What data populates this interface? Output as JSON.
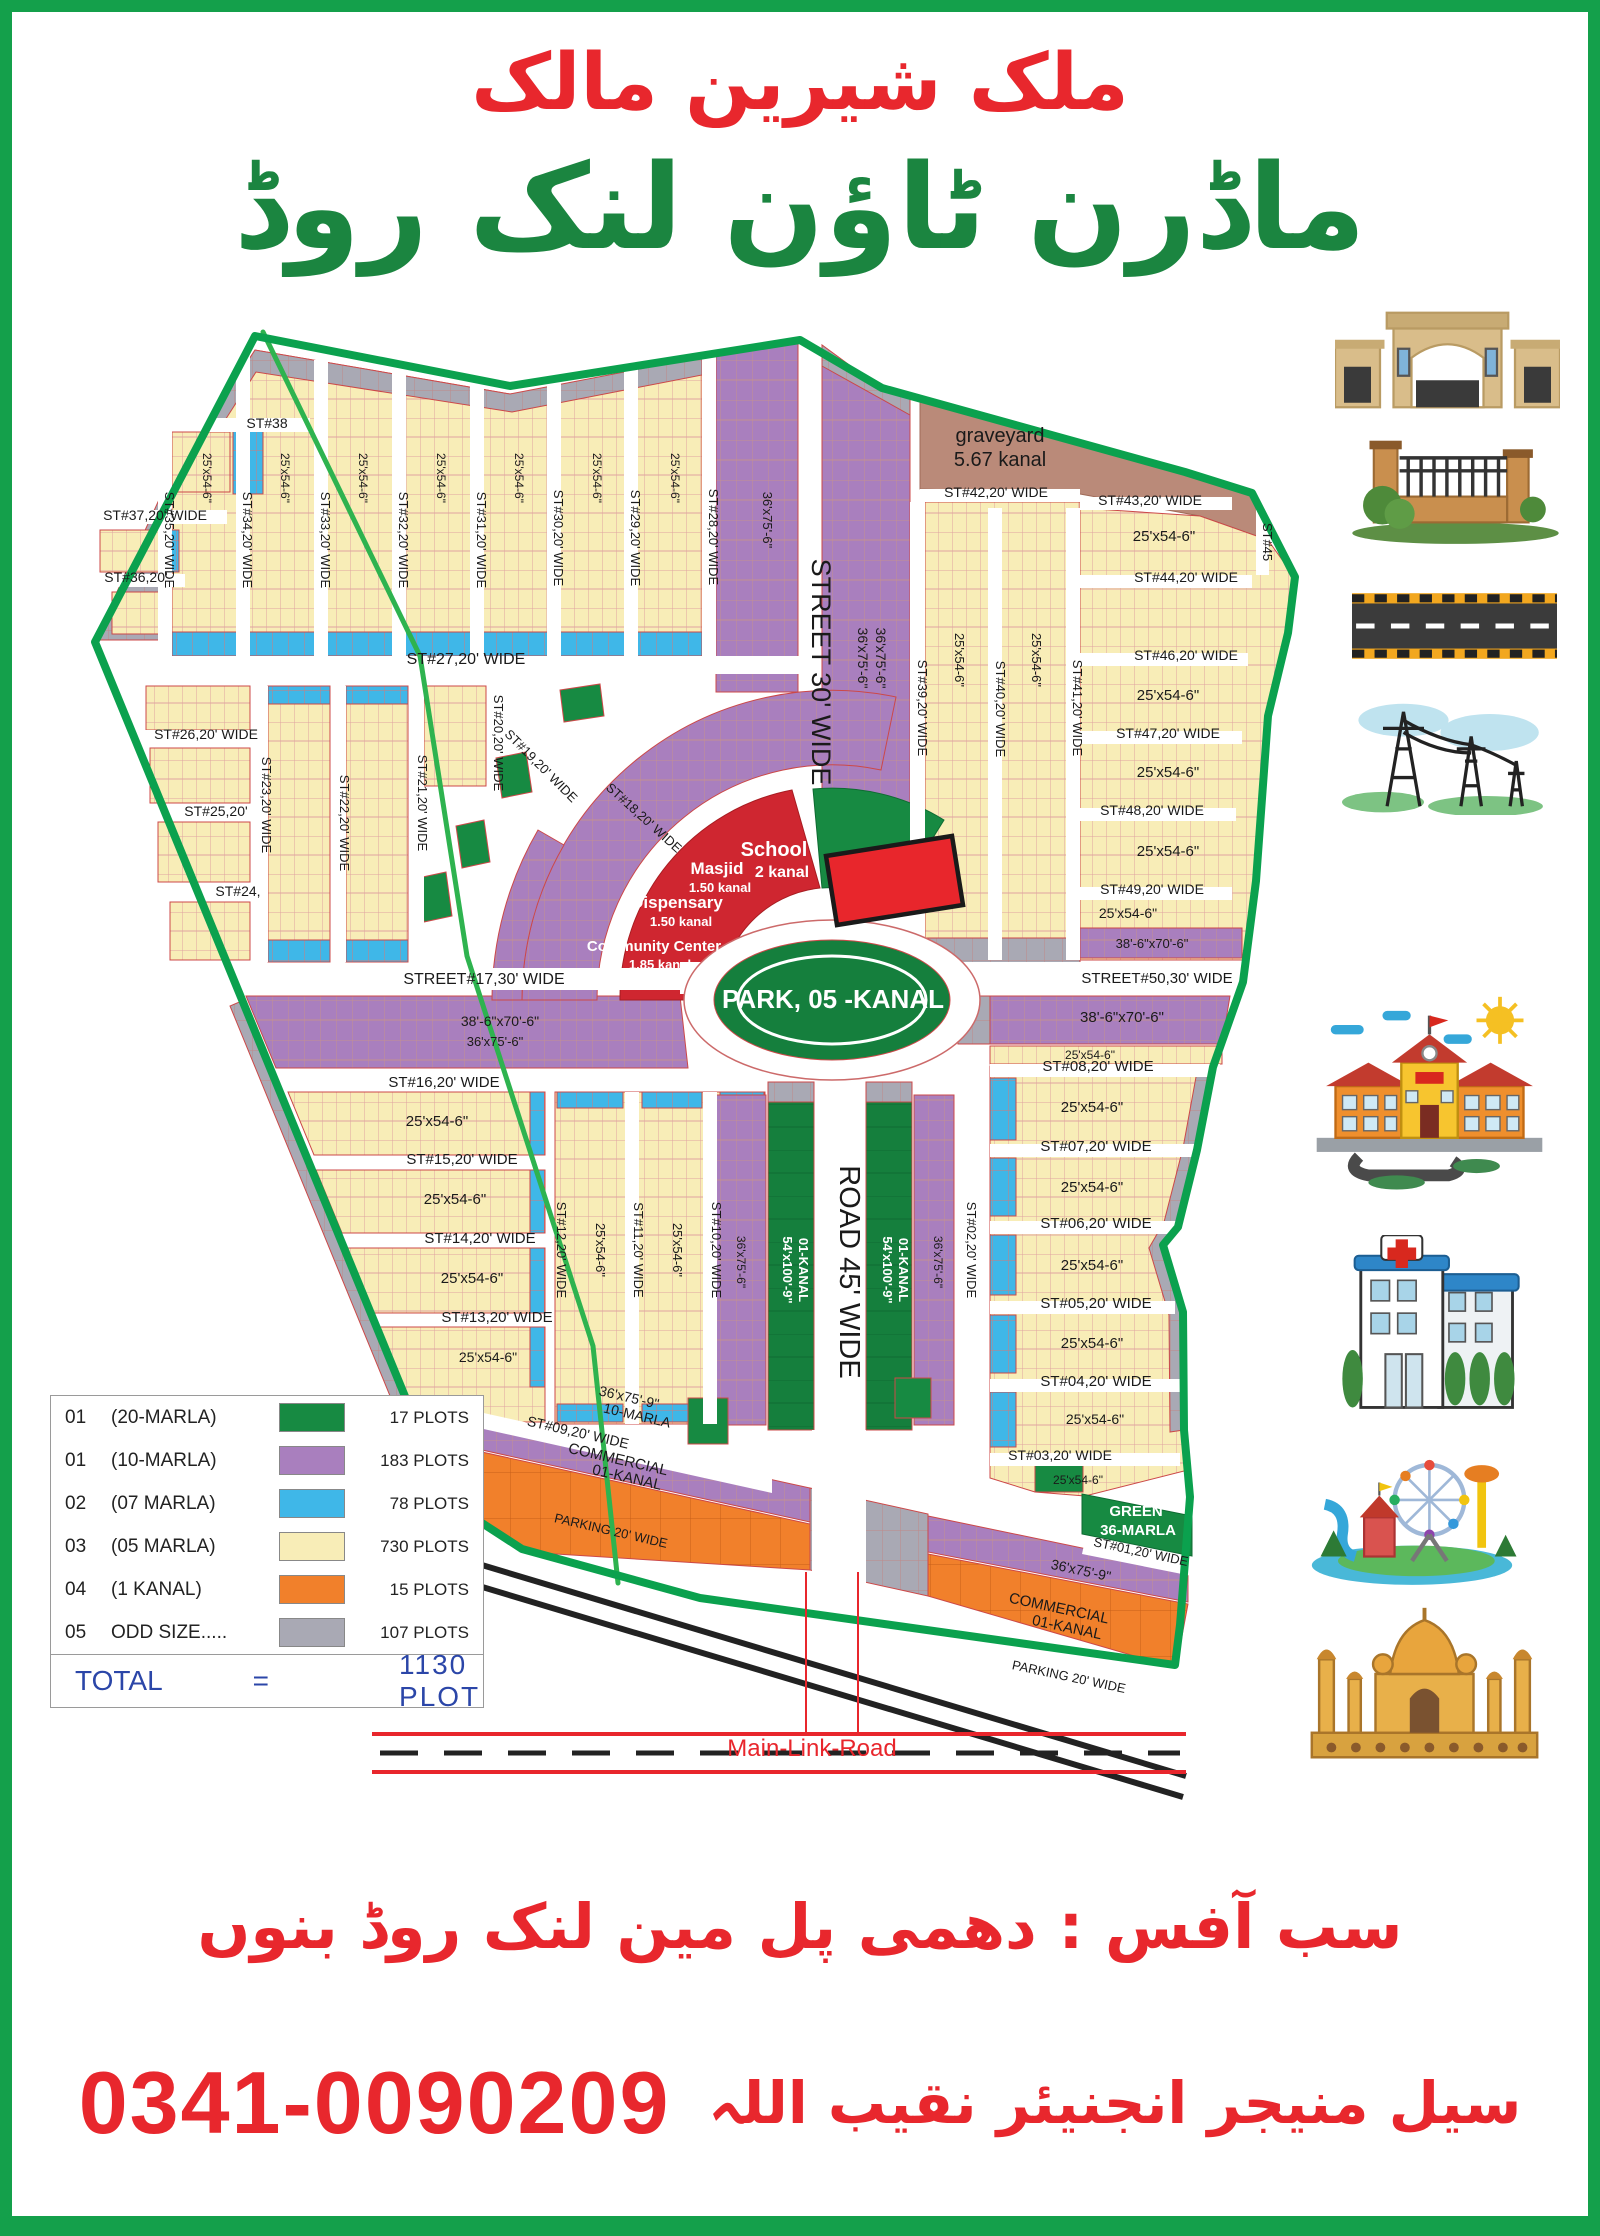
{
  "title": {
    "owner_urdu": "ملک شیرین مالک",
    "project_urdu": "ماڈرن ٹاؤن لنک روڈ"
  },
  "colors": {
    "boundary_green": "#0ba14e",
    "marla20_green": "#178a42",
    "marla10_purple": "#a97fbe",
    "marla7_blue": "#3fb7e8",
    "marla5_yellow": "#f8edb7",
    "kanal_orange": "#f1802b",
    "odd_gray": "#a9a9b4",
    "graveyard_brown": "#ba8a79",
    "facility_red": "#cf2630",
    "urdu_red": "#e8272d",
    "urdu_green": "#1b8540",
    "total_blue": "#2b46a8"
  },
  "legend": {
    "rows": [
      {
        "no": "01",
        "size": "(20-MARLA)",
        "plots": "17 PLOTS",
        "color": "#178a42"
      },
      {
        "no": "01",
        "size": "(10-MARLA)",
        "plots": "183 PLOTS",
        "color": "#a97fbe"
      },
      {
        "no": "02",
        "size": "(07 MARLA)",
        "plots": "78 PLOTS",
        "color": "#3fb7e8"
      },
      {
        "no": "03",
        "size": "(05 MARLA)",
        "plots": "730 PLOTS",
        "color": "#f8edb7"
      },
      {
        "no": "04",
        "size": "(1 KANAL)",
        "plots": "15 PLOTS",
        "color": "#f1802b"
      },
      {
        "no": "05",
        "size": "ODD SIZE.....",
        "plots": "107 PLOTS",
        "color": "#a9a9b4"
      }
    ],
    "total_label": "TOTAL",
    "equals_sign": "=",
    "total_value": "1130  PLOT"
  },
  "footer": {
    "office_urdu": "سب آفس : دھمی پل مین لنک روڈ بنوں",
    "manager_urdu": "سیل منیجر انجنیئر نقیب اللہ",
    "phone": "0341-0090209"
  },
  "icons": {
    "items": [
      "main-gate",
      "boundary-wall",
      "carpeted-road",
      "electricity-towers",
      "school",
      "hospital",
      "amusement-park",
      "mosque"
    ]
  },
  "map": {
    "street_labels": [
      {
        "t": "ST#38",
        "x": 267,
        "y": 428,
        "s": 14
      },
      {
        "t": "ST#37,20' WIDE",
        "x": 155,
        "y": 520,
        "s": 14
      },
      {
        "t": "ST#36,20'",
        "x": 136,
        "y": 582,
        "s": 14
      },
      {
        "t": "ST#27,20' WIDE",
        "x": 466,
        "y": 664,
        "s": 16
      },
      {
        "t": "ST#26,20' WIDE",
        "x": 206,
        "y": 739,
        "s": 14
      },
      {
        "t": "ST#25,20'",
        "x": 216,
        "y": 816,
        "s": 14
      },
      {
        "t": "ST#24,",
        "x": 238,
        "y": 896,
        "s": 14
      },
      {
        "t": "STREET#17,30' WIDE",
        "x": 484,
        "y": 984,
        "s": 16
      },
      {
        "t": "ST#16,20' WIDE",
        "x": 444,
        "y": 1087,
        "s": 15
      },
      {
        "t": "ST#15,20' WIDE",
        "x": 462,
        "y": 1164,
        "s": 15
      },
      {
        "t": "ST#14,20' WIDE",
        "x": 480,
        "y": 1243,
        "s": 15
      },
      {
        "t": "ST#13,20' WIDE",
        "x": 497,
        "y": 1322,
        "s": 15
      },
      {
        "t": "ST#09,20' WIDE",
        "x": 577,
        "y": 1437,
        "s": 14,
        "r": 13
      },
      {
        "t": "ST#42,20' WIDE",
        "x": 996,
        "y": 497,
        "s": 14
      },
      {
        "t": "ST#43,20' WIDE",
        "x": 1150,
        "y": 505,
        "s": 14
      },
      {
        "t": "ST#44,20' WIDE",
        "x": 1186,
        "y": 582,
        "s": 14
      },
      {
        "t": "ST#46,20' WIDE",
        "x": 1186,
        "y": 660,
        "s": 14
      },
      {
        "t": "ST#47,20' WIDE",
        "x": 1168,
        "y": 738,
        "s": 14
      },
      {
        "t": "ST#48,20' WIDE",
        "x": 1152,
        "y": 815,
        "s": 14
      },
      {
        "t": "ST#49,20' WIDE",
        "x": 1152,
        "y": 894,
        "s": 14
      },
      {
        "t": "STREET#50,30' WIDE",
        "x": 1157,
        "y": 983,
        "s": 15
      },
      {
        "t": "ST#08,20' WIDE",
        "x": 1098,
        "y": 1071,
        "s": 15
      },
      {
        "t": "ST#07,20' WIDE",
        "x": 1096,
        "y": 1151,
        "s": 15
      },
      {
        "t": "ST#06,20' WIDE",
        "x": 1096,
        "y": 1228,
        "s": 15
      },
      {
        "t": "ST#05,20' WIDE",
        "x": 1096,
        "y": 1308,
        "s": 15
      },
      {
        "t": "ST#04,20' WIDE",
        "x": 1096,
        "y": 1386,
        "s": 15
      },
      {
        "t": "ST#03,20' WIDE",
        "x": 1060,
        "y": 1460,
        "s": 14
      },
      {
        "t": "ST#01,20' WIDE",
        "x": 1140,
        "y": 1556,
        "s": 13,
        "r": 12
      },
      {
        "t": "ST#35,20' WIDE",
        "x": 165,
        "y": 540,
        "r": 90,
        "s": 13
      },
      {
        "t": "ST#34,20' WIDE",
        "x": 243,
        "y": 540,
        "r": 90,
        "s": 13
      },
      {
        "t": "ST#33,20' WIDE",
        "x": 321,
        "y": 540,
        "r": 90,
        "s": 13
      },
      {
        "t": "ST#32,20' WIDE",
        "x": 399,
        "y": 540,
        "r": 90,
        "s": 13
      },
      {
        "t": "ST#31,20' WIDE",
        "x": 477,
        "y": 540,
        "r": 90,
        "s": 13
      },
      {
        "t": "ST#30,20' WIDE",
        "x": 554,
        "y": 538,
        "r": 90,
        "s": 13
      },
      {
        "t": "ST#29,20' WIDE",
        "x": 631,
        "y": 538,
        "r": 90,
        "s": 13
      },
      {
        "t": "ST#28,20' WIDE",
        "x": 709,
        "y": 537,
        "r": 90,
        "s": 13
      },
      {
        "t": "STREET 30' WIDE",
        "x": 812,
        "y": 672,
        "r": 90,
        "s": 27
      },
      {
        "t": "ST#39,20' WIDE",
        "x": 918,
        "y": 708,
        "r": 90,
        "s": 13
      },
      {
        "t": "ST#40,20' WIDE",
        "x": 996,
        "y": 709,
        "r": 90,
        "s": 13
      },
      {
        "t": "ST#41,20' WIDE",
        "x": 1073,
        "y": 708,
        "r": 90,
        "s": 13
      },
      {
        "t": "ST#45",
        "x": 1263,
        "y": 542,
        "r": 90,
        "s": 13
      },
      {
        "t": "ST#23,20' WIDE",
        "x": 262,
        "y": 805,
        "r": 90,
        "s": 13
      },
      {
        "t": "ST#22,20' WIDE",
        "x": 340,
        "y": 823,
        "r": 90,
        "s": 13
      },
      {
        "t": "ST#21,20' WIDE",
        "x": 418,
        "y": 803,
        "r": 90,
        "s": 13
      },
      {
        "t": "ST#20,20' WIDE",
        "x": 494,
        "y": 743,
        "r": 90,
        "s": 13
      },
      {
        "t": "ST#19,20' WIDE",
        "x": 538,
        "y": 769,
        "r": 45,
        "s": 13
      },
      {
        "t": "ST#18,20' WIDE",
        "x": 641,
        "y": 821,
        "r": 42,
        "s": 13
      },
      {
        "t": "ST#12,20' WIDE",
        "x": 557,
        "y": 1250,
        "r": 90,
        "s": 13
      },
      {
        "t": "ST#11,20' WIDE",
        "x": 634,
        "y": 1250,
        "r": 90,
        "s": 13
      },
      {
        "t": "ST#10,20' WIDE",
        "x": 712,
        "y": 1250,
        "r": 90,
        "s": 13
      },
      {
        "t": "ROAD 45' WIDE",
        "x": 840,
        "y": 1272,
        "r": 90,
        "s": 29
      },
      {
        "t": "ST#02,20' WIDE",
        "x": 967,
        "y": 1250,
        "r": 90,
        "s": 13
      }
    ],
    "area_labels": [
      {
        "t": "graveyard",
        "x": 1000,
        "y": 442,
        "s": 20
      },
      {
        "t": "5.67 kanal",
        "x": 1000,
        "y": 466,
        "s": 20
      },
      {
        "t": "School",
        "x": 774,
        "y": 856,
        "s": 20,
        "c": "w",
        "b": 1
      },
      {
        "t": "2 kanal",
        "x": 782,
        "y": 877,
        "s": 16,
        "c": "w",
        "b": 1
      },
      {
        "t": "Masjid",
        "x": 717,
        "y": 874,
        "s": 17,
        "c": "w",
        "b": 1
      },
      {
        "t": "1.50 kanal",
        "x": 720,
        "y": 892,
        "s": 13,
        "c": "w",
        "b": 1
      },
      {
        "t": "Dispensary",
        "x": 677,
        "y": 908,
        "s": 17,
        "c": "w",
        "b": 1
      },
      {
        "t": "1.50 kanal",
        "x": 681,
        "y": 926,
        "s": 13,
        "c": "w",
        "b": 1
      },
      {
        "t": "Community Center",
        "x": 654,
        "y": 951,
        "s": 15,
        "c": "w",
        "b": 1
      },
      {
        "t": "1.85 kanal",
        "x": 660,
        "y": 969,
        "s": 13,
        "c": "w",
        "b": 1
      },
      {
        "t": "PARK, 05 -KANAL",
        "x": 833,
        "y": 1008,
        "s": 26,
        "c": "w",
        "b": 1
      },
      {
        "t": "36'x75'-6\"",
        "x": 763,
        "y": 520,
        "r": 90,
        "s": 13
      },
      {
        "t": "36'x75'-6\"",
        "x": 858,
        "y": 658,
        "r": 90,
        "s": 14
      },
      {
        "t": "36'x75'-6\"",
        "x": 876,
        "y": 658,
        "r": 90,
        "s": 14
      },
      {
        "t": "25'x54-6\"",
        "x": 203,
        "y": 478,
        "r": 90,
        "s": 12
      },
      {
        "t": "25'x54-6\"",
        "x": 281,
        "y": 478,
        "r": 90,
        "s": 12
      },
      {
        "t": "25'x54-6\"",
        "x": 359,
        "y": 478,
        "r": 90,
        "s": 12
      },
      {
        "t": "25'x54-6\"",
        "x": 437,
        "y": 478,
        "r": 90,
        "s": 12
      },
      {
        "t": "25'x54-6\"",
        "x": 515,
        "y": 478,
        "r": 90,
        "s": 12
      },
      {
        "t": "25'x54-6\"",
        "x": 593,
        "y": 478,
        "r": 90,
        "s": 12
      },
      {
        "t": "25'x54-6\"",
        "x": 671,
        "y": 478,
        "r": 90,
        "s": 12
      },
      {
        "t": "25'x54-6\"",
        "x": 955,
        "y": 660,
        "r": 90,
        "s": 13
      },
      {
        "t": "25'x54-6\"",
        "x": 1032,
        "y": 660,
        "r": 90,
        "s": 13
      },
      {
        "t": "25'x54-6\"",
        "x": 1164,
        "y": 541,
        "s": 15
      },
      {
        "t": "25'x54-6\"",
        "x": 1168,
        "y": 700,
        "s": 15
      },
      {
        "t": "25'x54-6\"",
        "x": 1168,
        "y": 777,
        "s": 15
      },
      {
        "t": "25'x54-6\"",
        "x": 1168,
        "y": 856,
        "s": 15
      },
      {
        "t": "25'x54-6\"",
        "x": 1128,
        "y": 918,
        "s": 14
      },
      {
        "t": "38'-6\"x70'-6\"",
        "x": 1152,
        "y": 948,
        "s": 13
      },
      {
        "t": "38'-6\"x70'-6\"",
        "x": 1122,
        "y": 1022,
        "s": 15
      },
      {
        "t": "25'x54-6\"",
        "x": 1090,
        "y": 1059,
        "s": 12
      },
      {
        "t": "25'x54-6\"",
        "x": 1092,
        "y": 1112,
        "s": 15
      },
      {
        "t": "25'x54-6\"",
        "x": 1092,
        "y": 1192,
        "s": 15
      },
      {
        "t": "25'x54-6\"",
        "x": 1092,
        "y": 1270,
        "s": 15
      },
      {
        "t": "25'x54-6\"",
        "x": 1092,
        "y": 1348,
        "s": 15
      },
      {
        "t": "25'x54-6\"",
        "x": 1095,
        "y": 1424,
        "s": 14
      },
      {
        "t": "25'x54-6\"",
        "x": 1078,
        "y": 1484,
        "s": 12
      },
      {
        "t": "38'-6\"x70'-6\"",
        "x": 500,
        "y": 1026,
        "s": 14
      },
      {
        "t": "36'x75'-6\"",
        "x": 495,
        "y": 1046,
        "s": 13
      },
      {
        "t": "25'x54-6\"",
        "x": 437,
        "y": 1126,
        "s": 15
      },
      {
        "t": "25'x54-6\"",
        "x": 455,
        "y": 1204,
        "s": 15
      },
      {
        "t": "25'x54-6\"",
        "x": 472,
        "y": 1283,
        "s": 15
      },
      {
        "t": "25'x54-6\"",
        "x": 488,
        "y": 1362,
        "s": 14
      },
      {
        "t": "25'x54-6\"",
        "x": 596,
        "y": 1250,
        "r": 90,
        "s": 13
      },
      {
        "t": "25'x54-6\"",
        "x": 673,
        "y": 1250,
        "r": 90,
        "s": 13
      },
      {
        "t": "54'x100'-9\"",
        "x": 783,
        "y": 1270,
        "r": 90,
        "s": 13,
        "c": "w",
        "b": 1
      },
      {
        "t": "01-KANAL",
        "x": 799,
        "y": 1270,
        "r": 90,
        "s": 13,
        "c": "w",
        "b": 1
      },
      {
        "t": "54'x100'-9\"",
        "x": 883,
        "y": 1270,
        "r": 90,
        "s": 13,
        "c": "w",
        "b": 1
      },
      {
        "t": "01-KANAL",
        "x": 899,
        "y": 1270,
        "r": 90,
        "s": 13,
        "c": "w",
        "b": 1
      },
      {
        "t": "36'x75'-6\"",
        "x": 737,
        "y": 1262,
        "r": 90,
        "s": 12
      },
      {
        "t": "36'x75'-6\"",
        "x": 934,
        "y": 1262,
        "r": 90,
        "s": 12
      },
      {
        "t": "36'x75'-9\"",
        "x": 628,
        "y": 1402,
        "r": 13,
        "s": 14
      },
      {
        "t": "10-MARLA",
        "x": 636,
        "y": 1420,
        "r": 13,
        "s": 14
      },
      {
        "t": "COMMERCIAL",
        "x": 617,
        "y": 1464,
        "r": 13,
        "s": 15
      },
      {
        "t": "01-KANAL",
        "x": 626,
        "y": 1482,
        "r": 13,
        "s": 15
      },
      {
        "t": "PARKING 20' WIDE",
        "x": 610,
        "y": 1535,
        "r": 13,
        "s": 13
      },
      {
        "t": "36'x75'-9\"",
        "x": 1080,
        "y": 1575,
        "r": 12,
        "s": 14
      },
      {
        "t": "COMMERCIAL",
        "x": 1058,
        "y": 1613,
        "r": 12,
        "s": 15
      },
      {
        "t": "01-KANAL",
        "x": 1066,
        "y": 1632,
        "r": 12,
        "s": 15
      },
      {
        "t": "PARKING 20' WIDE",
        "x": 1068,
        "y": 1681,
        "r": 12,
        "s": 13
      },
      {
        "t": "GREEN",
        "x": 1136,
        "y": 1516,
        "s": 15,
        "c": "w",
        "b": 1
      },
      {
        "t": "36-MARLA",
        "x": 1138,
        "y": 1535,
        "s": 15,
        "c": "w",
        "b": 1
      },
      {
        "t": "Main-Link-Road",
        "x": 812,
        "y": 1756,
        "s": 24,
        "c": "r"
      }
    ]
  }
}
